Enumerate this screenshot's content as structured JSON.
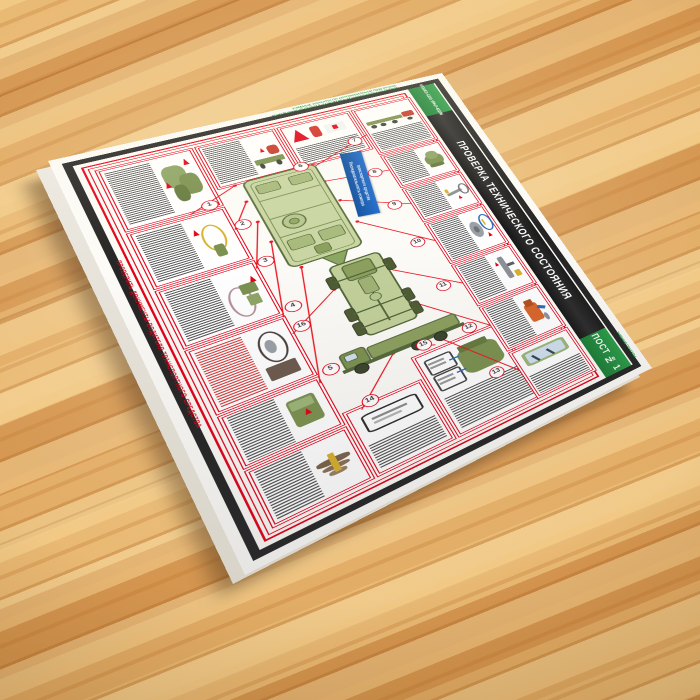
{
  "poster": {
    "title": "ПРОВЕРКА ТЕХНИЧЕСКОГО СОСТОЯНИЯ",
    "models_badge": {
      "line1": "КАМАЗ-4350",
      "line2": "УРАЛ-43206"
    },
    "post_badge": "ПОСТ № 1",
    "left_edge_note": "ПРОВЕРИТЬ ДОКУМЕНТЫ ВОДИТЕЛЯ ТРАНСПОРТНОГО СРЕДСТВА",
    "top_edge_note": {
      "line1": "УЧЕБНЫЕ ПЛАКАТЫ ПО АВТОМОБИЛЬНОЙ ПОДГОТОВКЕ",
      "line2": "КОНТРОЛЬНЫЙ ОСМОТР И ПРОВЕРКА ТЕХНИЧЕСКОГО СОСТОЯНИЯ"
    },
    "right_edge_note": "УЧЕБНЫЕ ПЛАКАТЫ",
    "blue_ribbon": {
      "line1": "Последовательность осмотра",
      "line2": "транспортного средства"
    },
    "callout_numbers": [
      "1",
      "2",
      "3",
      "4",
      "5",
      "6",
      "7",
      "8",
      "9",
      "10",
      "11",
      "12",
      "13",
      "14",
      "15",
      "16"
    ],
    "colors": {
      "accent_red": "#e30016",
      "banner_black": "#262525",
      "badge_green": "#2a9d47",
      "ribbon_blue": "#1e6bcc",
      "army_green": "#7c9150",
      "wood": "#dca35e"
    },
    "boxes": [
      {
        "id": "transfer-case",
        "art": "transfer-case-icon"
      },
      {
        "id": "tow-vehicle",
        "art": "tow-vehicle-icon"
      },
      {
        "id": "safety-equipment",
        "art": "warning-triangle-extinguisher-firstaid-icon"
      },
      {
        "id": "road-train",
        "art": "road-train-icon"
      },
      {
        "id": "pintle-hook",
        "art": "pintle-hook-icon"
      },
      {
        "id": "suspension",
        "art": "suspension-icon"
      },
      {
        "id": "wheel-tire",
        "art": "wheel-tire-icon"
      },
      {
        "id": "van-body",
        "art": "van-body-icon"
      },
      {
        "id": "leaf-spring",
        "art": "leaf-spring-icon"
      },
      {
        "id": "plates-documents",
        "art": "registration-plate-icon"
      },
      {
        "id": "engine-compartment",
        "art": "engine-icon"
      },
      {
        "id": "tarp-cover",
        "art": "tarp-icon"
      },
      {
        "id": "tow-rope",
        "art": "tow-rope-icon"
      },
      {
        "id": "wheel-valve",
        "art": "wheel-valve-magnifier-icon"
      },
      {
        "id": "mirrors",
        "art": "mirror-icon"
      },
      {
        "id": "cab-heater",
        "art": "cab-heater-icon"
      },
      {
        "id": "windshield-wipers",
        "art": "windshield-wiper-icon"
      }
    ]
  }
}
